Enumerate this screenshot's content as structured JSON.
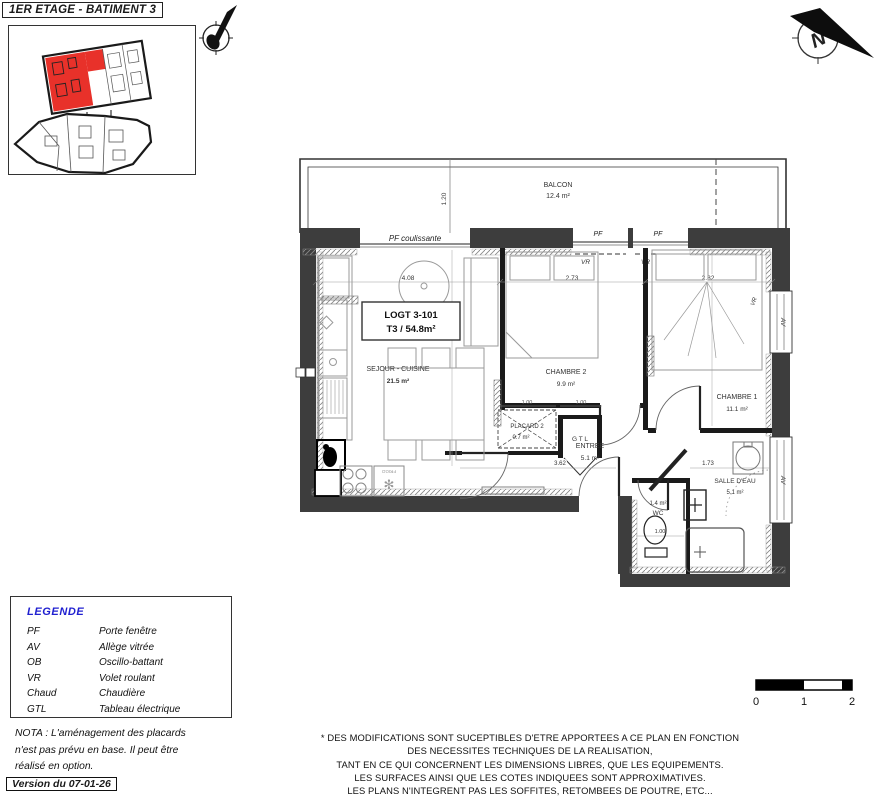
{
  "header": {
    "title": "1ER ETAGE - BATIMENT 3"
  },
  "compass": {
    "north_letter": "N"
  },
  "plan": {
    "unit_box": {
      "line1": "LOGT 3-101",
      "line2": "T3 / 54.8m²"
    },
    "rooms": {
      "balcon": {
        "name": "BALCON",
        "area": "12.4 m²"
      },
      "sejour": {
        "name": "SEJOUR - CUISINE",
        "area": "21.5 m²"
      },
      "chambre2": {
        "name": "CHAMBRE 2",
        "area": "9.9 m²"
      },
      "chambre1": {
        "name": "CHAMBRE 1",
        "area": "11.1 m²"
      },
      "entree": {
        "name": "ENTREE",
        "area": "5.1 m²"
      },
      "placard": {
        "name": "PLACARD 2",
        "area": "0.7 m²"
      },
      "wc": {
        "name": "WC",
        "area": "1.4 m²"
      },
      "salle_eau": {
        "name": "SALLE D'EAU",
        "area": "5.1 m²"
      },
      "gtl": {
        "name": "G T L"
      }
    },
    "labels": {
      "pf_coulissante": "PF coulissante",
      "pf1": "PF",
      "pf2": "PF",
      "vr1": "VR",
      "vr2": "VR",
      "vr3": "VR",
      "av1": "AV",
      "av2": "AV",
      "frigo": "FRIGO"
    },
    "dimensions": {
      "sejour_w": "4.08",
      "chambre2_w": "2.73",
      "chambre1_w": "2.82",
      "balcon_d": "1.20",
      "entree_w": "3.62",
      "salle_eau_w": "1.73",
      "wc_w": "1.00",
      "placard_w": "1.00",
      "gtl_w": "1.00"
    }
  },
  "legend": {
    "title": "LEGENDE",
    "items": [
      {
        "abbr": "PF",
        "label": "Porte fenêtre"
      },
      {
        "abbr": "AV",
        "label": "Allège vitrée"
      },
      {
        "abbr": "OB",
        "label": "Oscillo-battant"
      },
      {
        "abbr": "VR",
        "label": "Volet roulant"
      },
      {
        "abbr": "Chaud",
        "label": "Chaudière"
      },
      {
        "abbr": "GTL",
        "label": "Tableau électrique"
      }
    ]
  },
  "nota": {
    "line1": "NOTA : L'aménagement des placards",
    "line2": "n'est pas prévu en base. Il peut être",
    "line3": "réalisé en option."
  },
  "version": "Version du 07-01-26",
  "scale_bar": {
    "t0": "0",
    "t1": "1",
    "t2": "2"
  },
  "disclaimer": {
    "line1": "* DES MODIFICATIONS SONT SUCEPTIBLES D'ETRE APPORTEES A CE PLAN EN FONCTION",
    "line2": "DES NECESSITES TECHNIQUES DE LA REALISATION,",
    "line3": "TANT EN CE QUI CONCERNENT LES DIMENSIONS LIBRES, QUE LES EQUIPEMENTS.",
    "line4": "LES SURFACES AINSI QUE LES COTES INDIQUEES SONT APPROXIMATIVES.",
    "line5": "LES PLANS N'INTEGRENT PAS LES SOFFITES, RETOMBEES DE POUTRE, ETC..."
  },
  "colors": {
    "highlight_red": "#e8312a",
    "legend_blue": "#2020d0",
    "wall_dark": "#3d3d3d"
  }
}
